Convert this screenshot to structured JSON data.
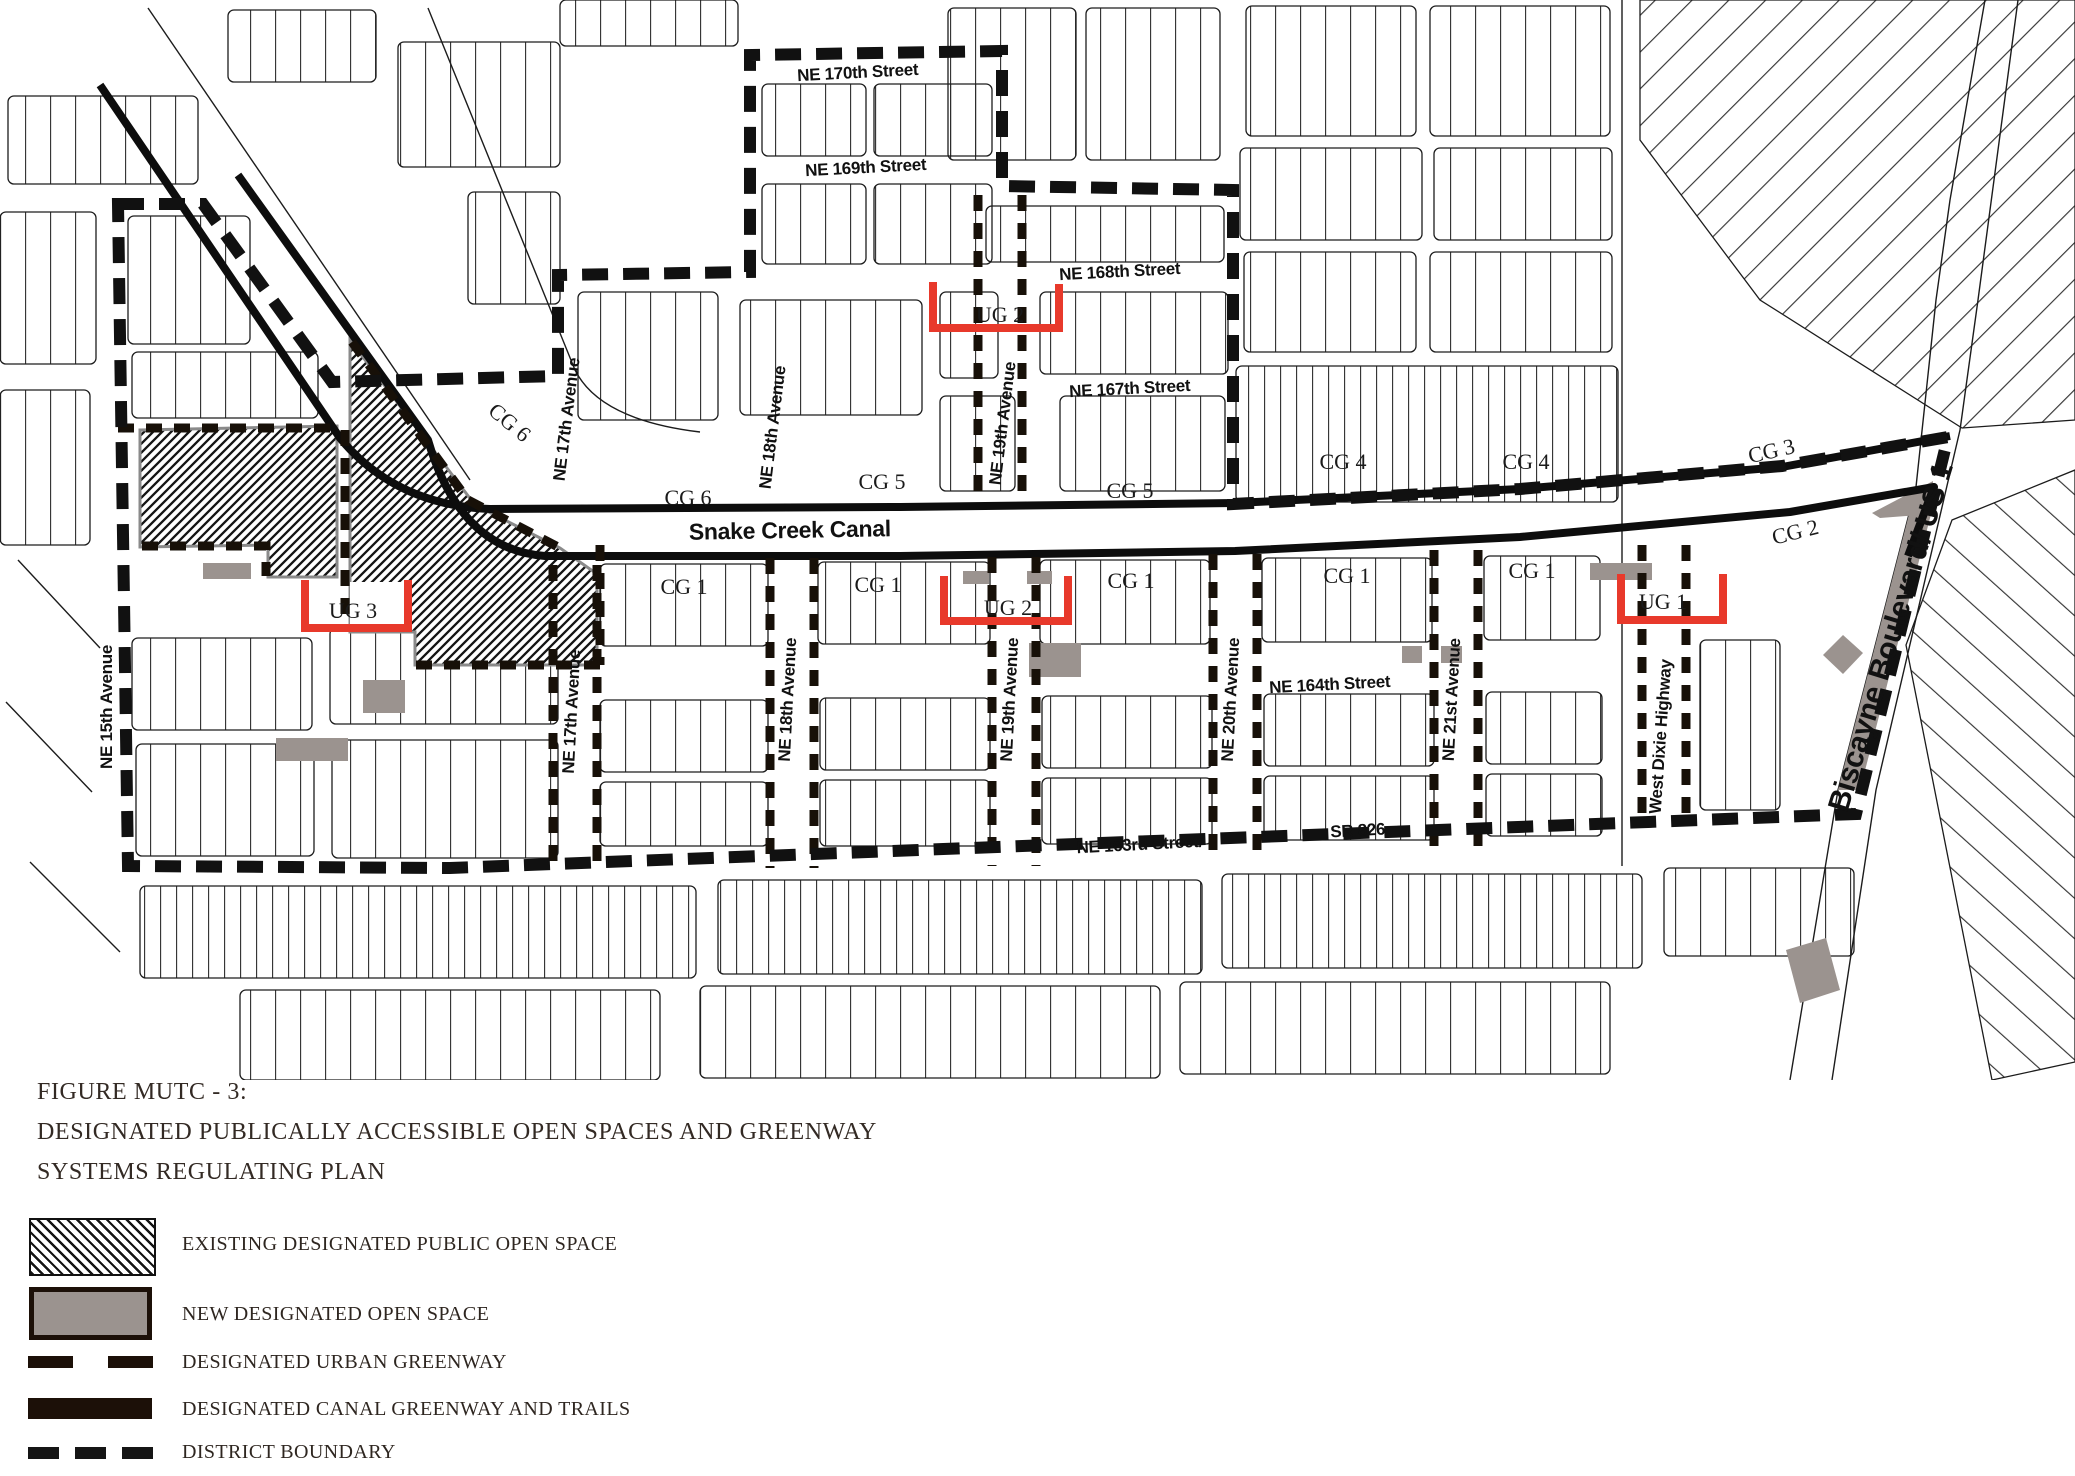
{
  "figure": {
    "id_line": "FIGURE MUTC - 3:",
    "title_line2": "DESIGNATED PUBLICALLY ACCESSIBLE OPEN SPACES AND GREENWAY",
    "title_line3": "SYSTEMS REGULATING PLAN"
  },
  "legend": {
    "items": [
      {
        "key": "existing-open-space",
        "label": "EXISTING DESIGNATED PUBLIC OPEN SPACE",
        "swatch": "hatched"
      },
      {
        "key": "new-open-space",
        "label": "NEW DESIGNATED OPEN SPACE",
        "swatch": "gray-fill"
      },
      {
        "key": "urban-greenway",
        "label": "DESIGNATED URBAN GREENWAY",
        "swatch": "dashed-line"
      },
      {
        "key": "canal-greenway",
        "label": "DESIGNATED CANAL GREENWAY AND TRAILS",
        "swatch": "solid-line"
      },
      {
        "key": "district-boundary",
        "label": "DISTRICT BOUNDARY",
        "swatch": "bold-dashed-line"
      }
    ]
  },
  "map": {
    "canal_label": "Snake Creek Canal",
    "street_labels": [
      {
        "text": "NE 170th Street"
      },
      {
        "text": "NE 169th Street"
      },
      {
        "text": "NE 168th Street"
      },
      {
        "text": "NE 167th Street"
      },
      {
        "text": "NE 164th Street"
      },
      {
        "text": "NE 163rd Street/"
      },
      {
        "text": "SR 826"
      }
    ],
    "avenue_labels": [
      {
        "text": "NE 15th Avenue"
      },
      {
        "text": "NE 17th Avenue"
      },
      {
        "text": "NE 18th Avenue"
      },
      {
        "text": "NE 19th Avenue"
      },
      {
        "text": "NE 17th Avenue"
      },
      {
        "text": "NE 18th Avenue"
      },
      {
        "text": "NE 19th Avenue"
      },
      {
        "text": "NE 20th Avenue"
      },
      {
        "text": "NE 21st Avenue"
      },
      {
        "text": "West Dixie Highway"
      },
      {
        "text": "Biscayne Boulevard/ US 1"
      }
    ],
    "zone_labels": [
      {
        "text": "CG 6"
      },
      {
        "text": "CG 6"
      },
      {
        "text": "CG 5"
      },
      {
        "text": "CG 5"
      },
      {
        "text": "CG 4"
      },
      {
        "text": "CG 4"
      },
      {
        "text": "CG 3"
      },
      {
        "text": "CG 2"
      },
      {
        "text": "CG 1"
      },
      {
        "text": "CG 1"
      },
      {
        "text": "CG 1"
      },
      {
        "text": "CG 1"
      },
      {
        "text": "CG 1"
      }
    ],
    "ug_labels": [
      {
        "text": "UG 2"
      },
      {
        "text": "UG 2"
      },
      {
        "text": "UG 3"
      },
      {
        "text": "UG 1"
      }
    ]
  },
  "colors": {
    "accent_red": "#e8392b",
    "open_space_gray": "#9b938f",
    "legend_brown": "#1c1008",
    "ink": "#141414"
  }
}
